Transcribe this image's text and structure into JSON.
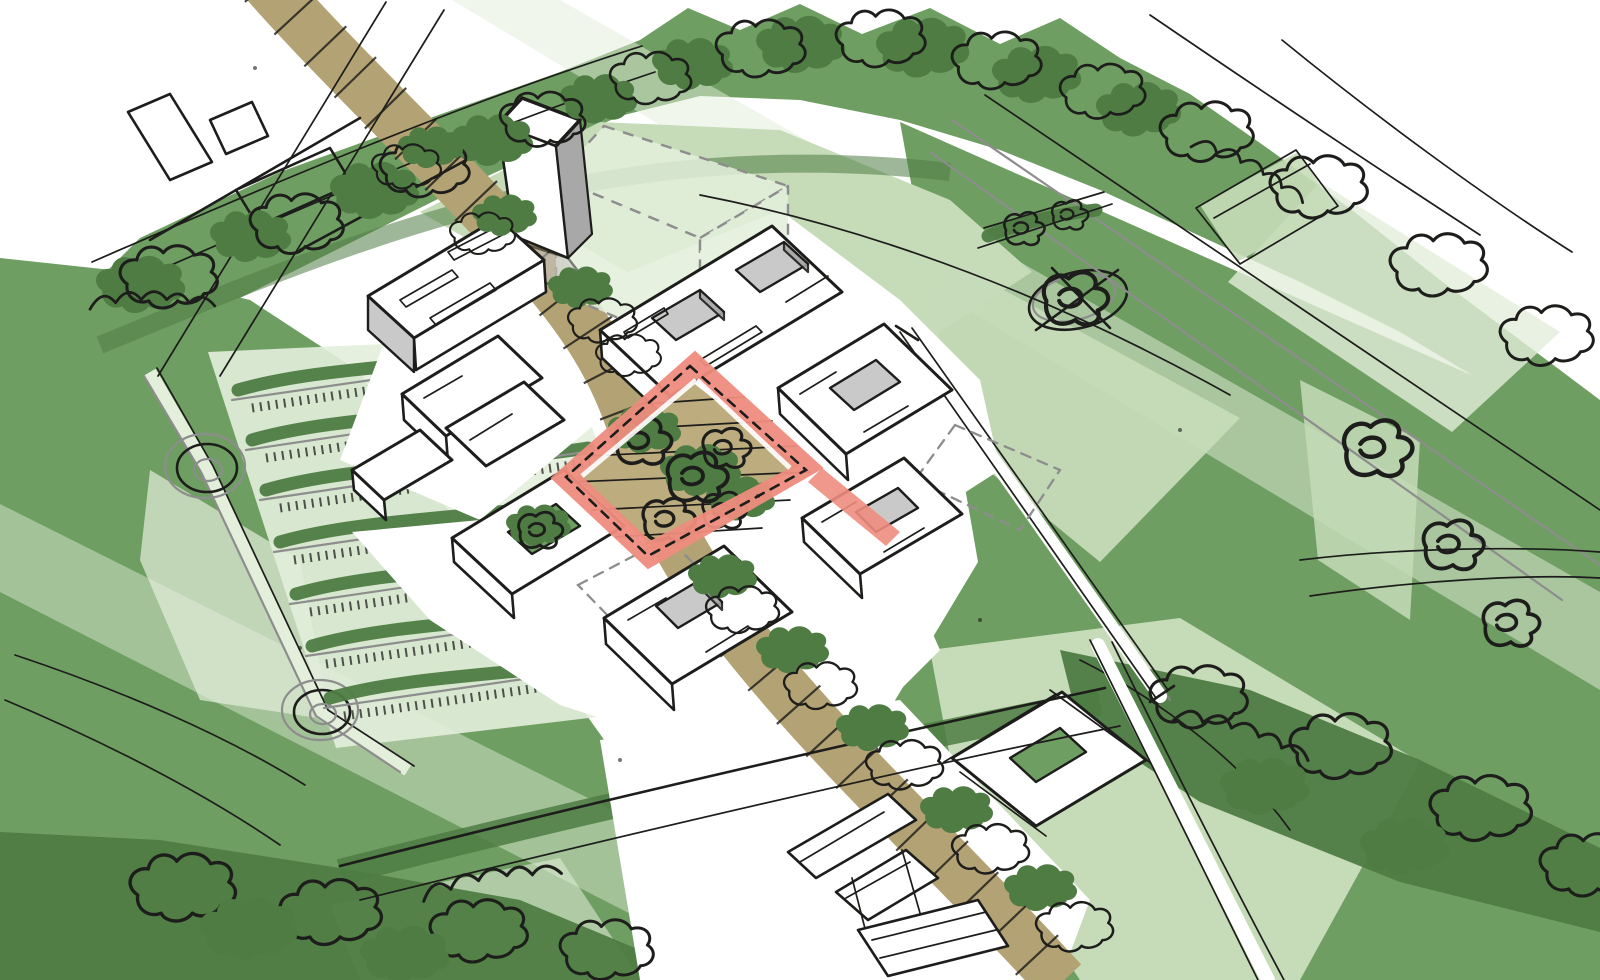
{
  "meta": {
    "type": "architectural-concept-sketch",
    "view": "aerial-axonometric",
    "description": "Hand-drawn masterplan sketch: campus of white courtyard buildings around a central courtyard highlighted with a red frame, a tan road crossing diagonally, parking rows with hedges, lawns, tree belts and paths drawn in loose black ink over green washes"
  },
  "colors": {
    "paper": "#ffffff",
    "ink": "#1d1d1b",
    "gray_sketch": "#8d8d8d",
    "gray_light": "#c9c9c9",
    "gray_mid": "#a8a8a8",
    "green_medium": "#6f9e62",
    "green_dark": "#4e7c43",
    "green_light": "#c6dbb8",
    "green_pale": "#e3eedb",
    "road_tan": "#b3a273",
    "courtyard_tan": "#bcac7e",
    "highlight_red": "#ef8d7f",
    "highlight_red_deep": "#e4624f"
  },
  "scene": {
    "regions": [
      {
        "id": "landscape",
        "label": "Green landscape with tree belts, hedges and lawns"
      },
      {
        "id": "road",
        "label": "Tan road crossing the site diagonally with paving marks"
      },
      {
        "id": "campus",
        "label": "Campus of white courtyard buildings in axonometric sketch"
      },
      {
        "id": "courtyard-highlight",
        "label": "Central courtyard highlighted with red frame and tan paving"
      },
      {
        "id": "parking",
        "label": "Parking rows with hedge strips and access lane with turning circles"
      },
      {
        "id": "tower",
        "label": "Tall tower building"
      },
      {
        "id": "ghost-massing",
        "label": "Translucent future massing block with dashed outline"
      },
      {
        "id": "wall",
        "label": "Long diagonal wall element on eastern lawn"
      },
      {
        "id": "tree-circle",
        "label": "Scribbled tree circle on lawn"
      },
      {
        "id": "paths",
        "label": "Thin sketched paths and construction lines"
      }
    ]
  }
}
